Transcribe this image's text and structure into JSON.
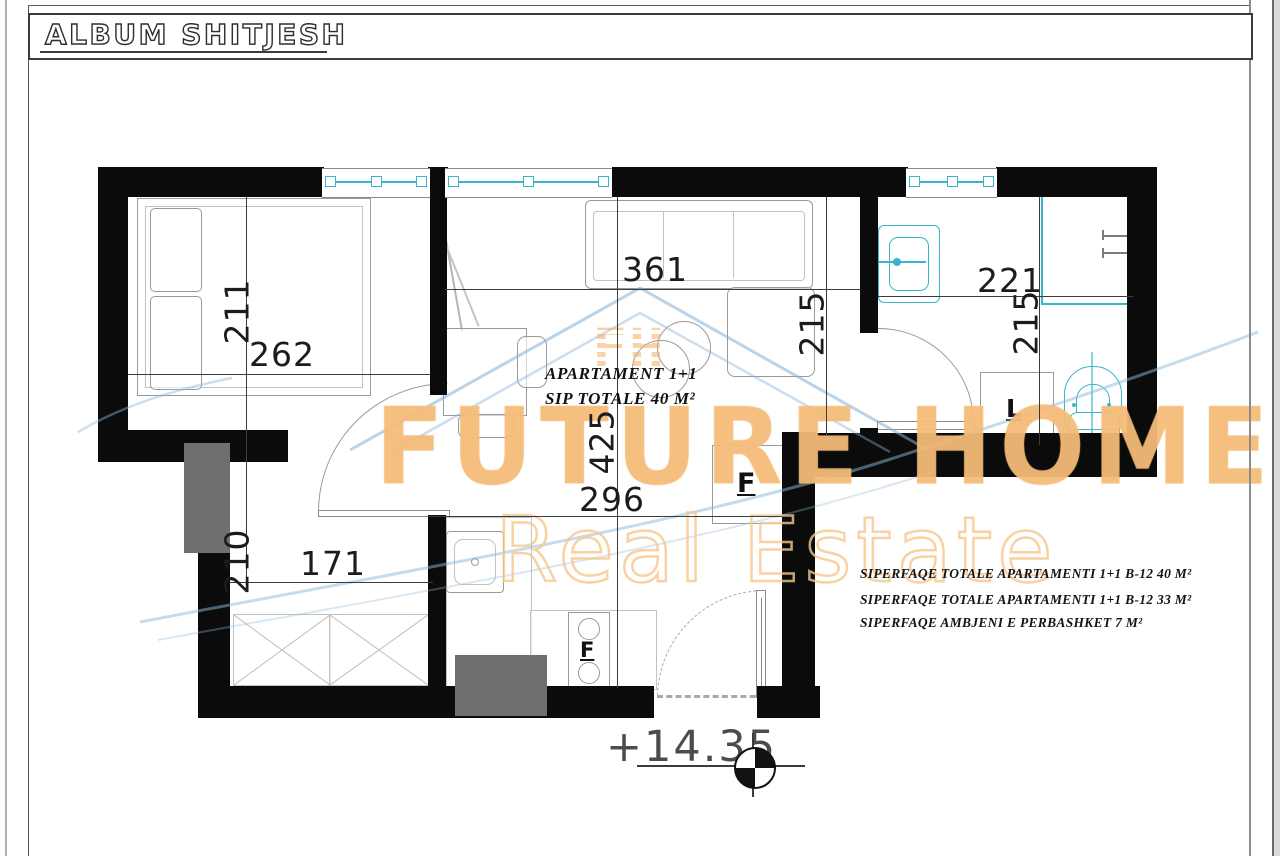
{
  "title": "ALBUM SHITJESH",
  "apartment": {
    "line1": "APARTAMENT  1+1",
    "line2": "SIP TOTALE  40 M²"
  },
  "areas": [
    "SIPERFAQE TOTALE APARTAMENTI 1+1 B-12  40 M²",
    "SIPERFAQE TOTALE APARTAMENTI 1+1 B-12  33 M²",
    "SIPERFAQE AMBJENI E PERBASHKET   7 M²"
  ],
  "elevation": "+14.35",
  "dimensions": {
    "bedroom_height": "211",
    "bedroom_width": "262",
    "hall_height": "210",
    "hall_width": "171",
    "living_width": "361",
    "living_depth": "425",
    "living_height": "215",
    "kitchen_width": "296",
    "bath_width": "221",
    "bath_height": "215"
  },
  "labels": {
    "fridge": "F",
    "stove": "F",
    "washer": "L"
  },
  "watermark": {
    "brand": "FUTURE HOME",
    "tagline": "Real Estate",
    "monogram": "FH"
  },
  "colors": {
    "wall": "#0b0b0b",
    "fixture_cyan": "#3ab3cc",
    "watermark_orange": "#f6c087",
    "watermark_blue": "#82aed7"
  }
}
